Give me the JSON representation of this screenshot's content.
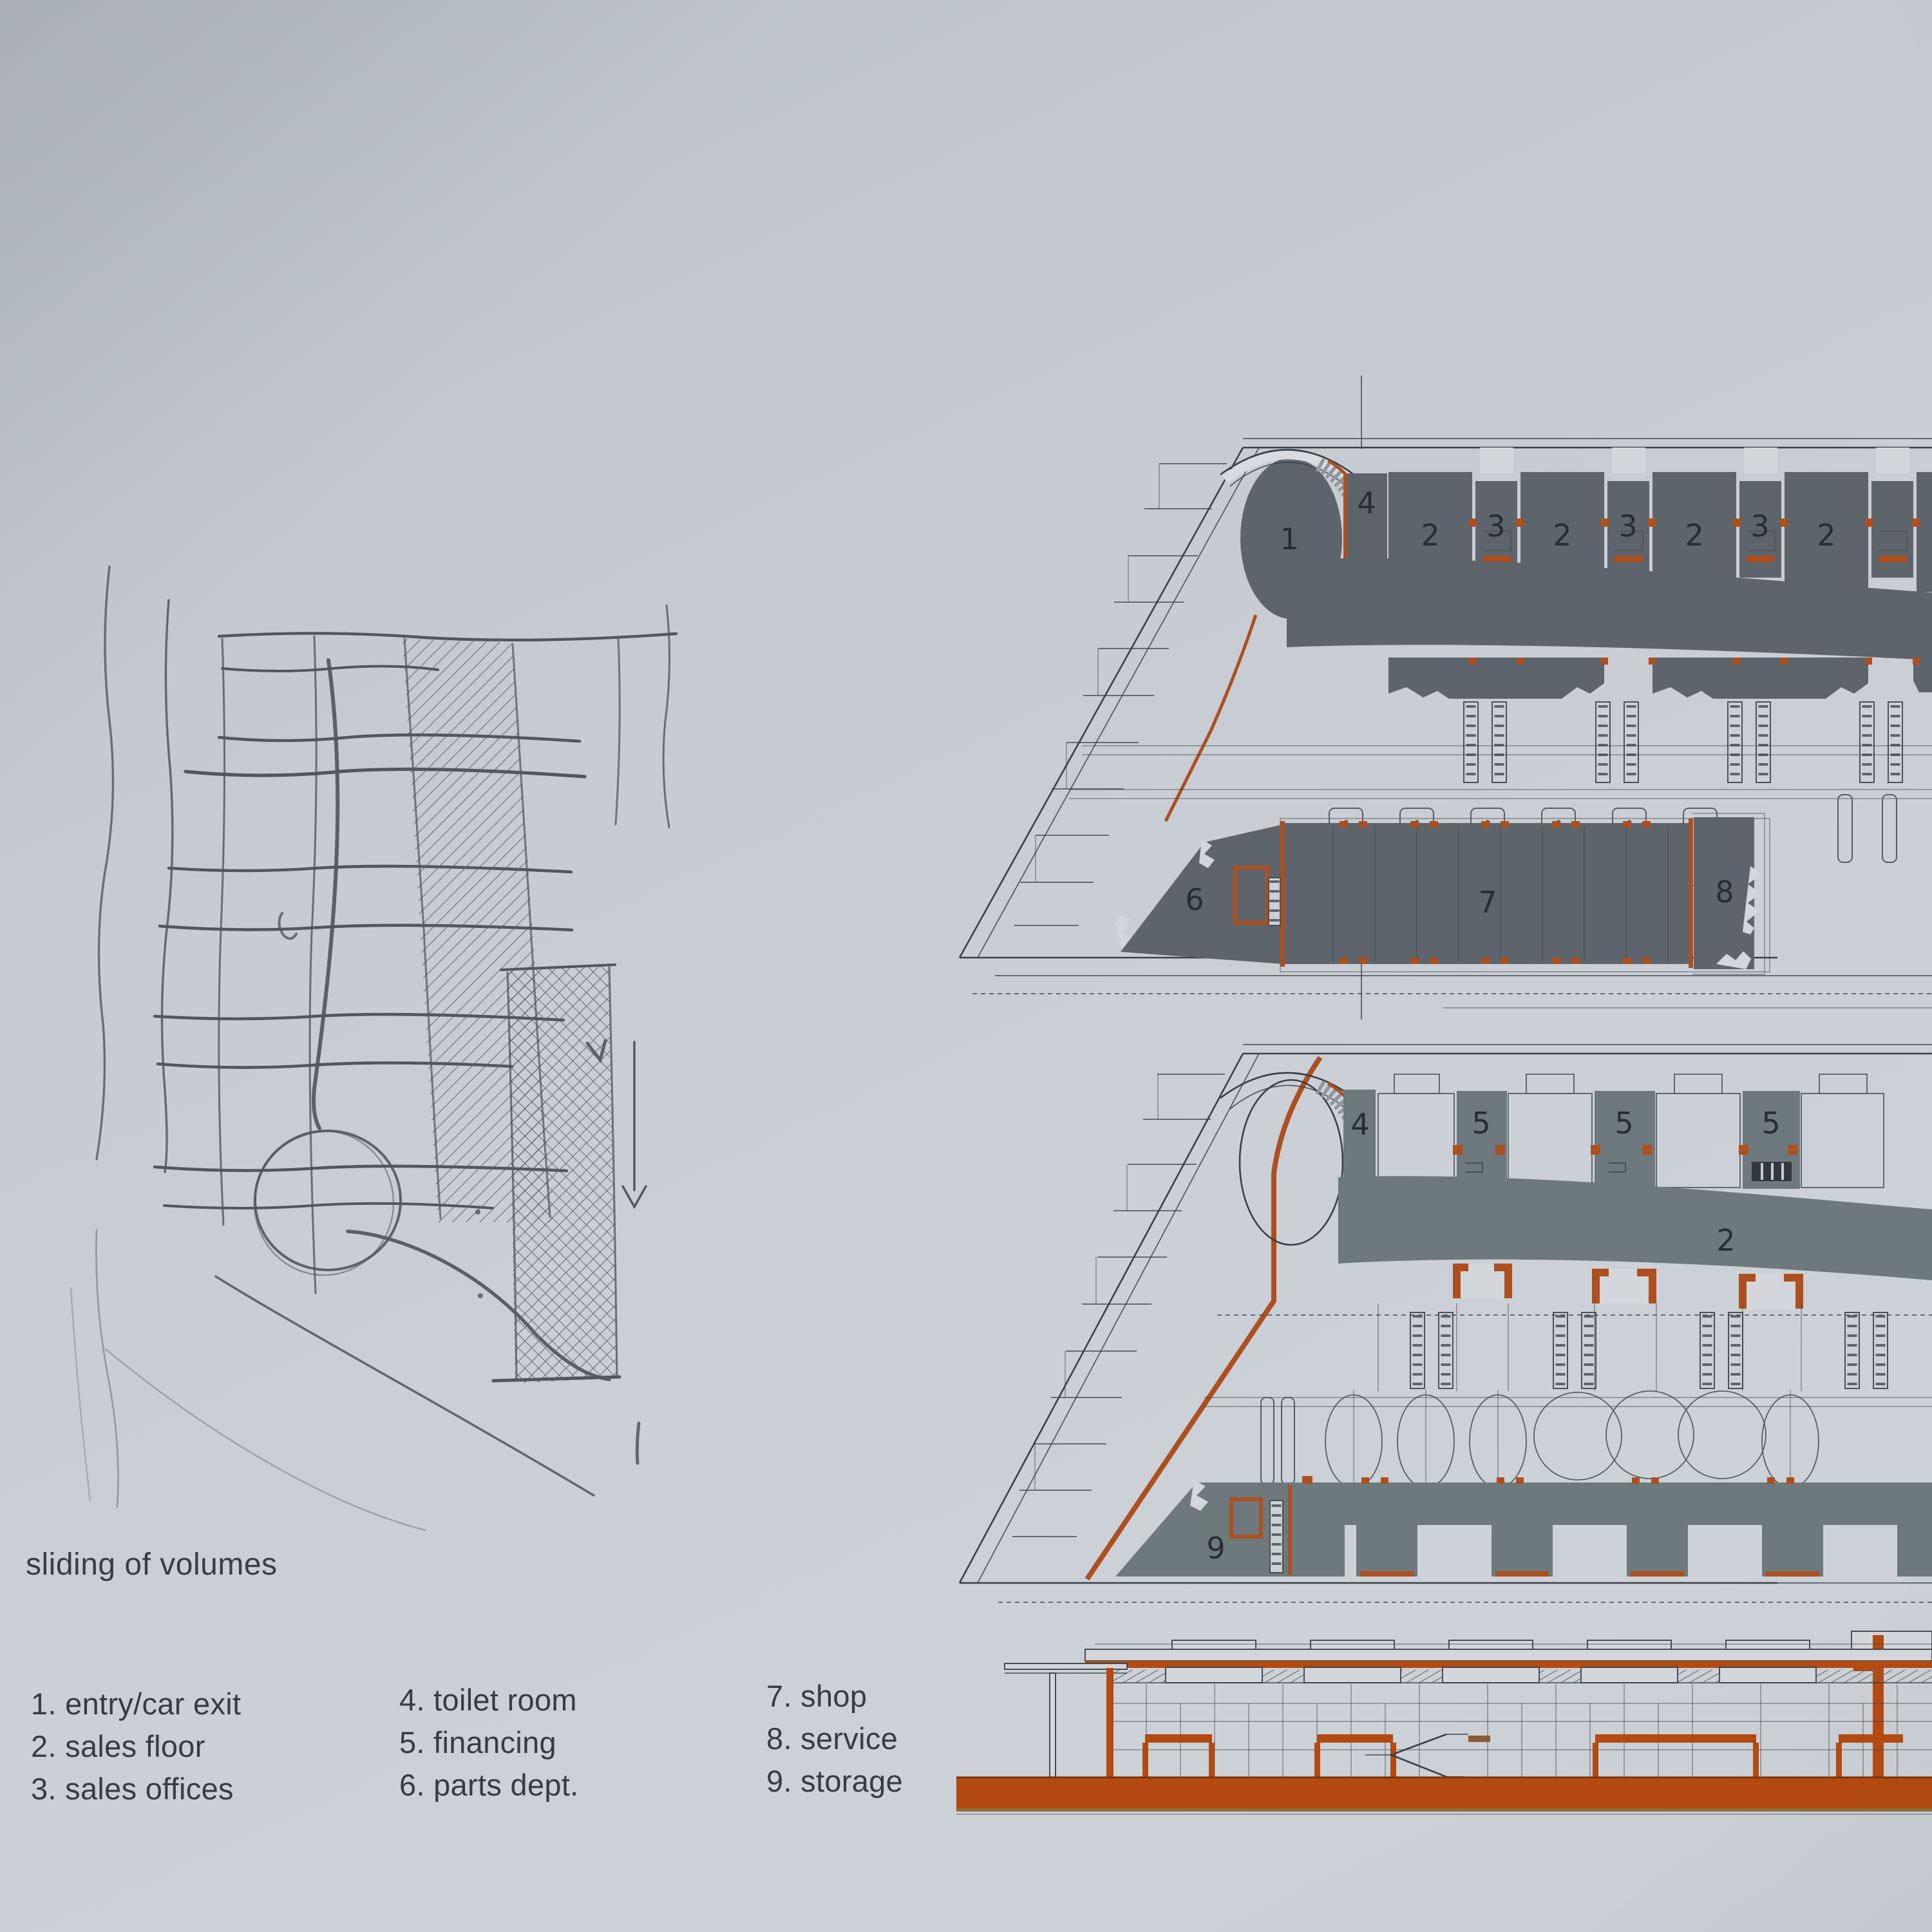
{
  "caption": "sliding of volumes",
  "legend": {
    "items": [
      "1. entry/car exit",
      "2. sales floor",
      "3. sales offices",
      "4. toilet room",
      "5. financing",
      "6. parts dept.",
      "7. shop",
      "8. service",
      "9. storage"
    ]
  },
  "plans": {
    "ground": {
      "title": "ground floor plan",
      "top_labels": [
        "1",
        "4",
        "2",
        "3",
        "2",
        "3",
        "2",
        "3",
        "2"
      ],
      "bottom_labels": [
        "6",
        "7",
        "8"
      ]
    },
    "upper": {
      "title": "upper floor plan",
      "top_labels": [
        "4",
        "5",
        "5",
        "5"
      ],
      "band_label": "2",
      "bottom_label": "9"
    }
  },
  "colors": {
    "ink": "#3a4047",
    "pencil": "#53565b",
    "gray1": "#5d646b",
    "gray2": "#6d797c",
    "orange": "#ad4f1e",
    "elev_orange": "#b34a12",
    "paper": "#c6cbd1"
  }
}
